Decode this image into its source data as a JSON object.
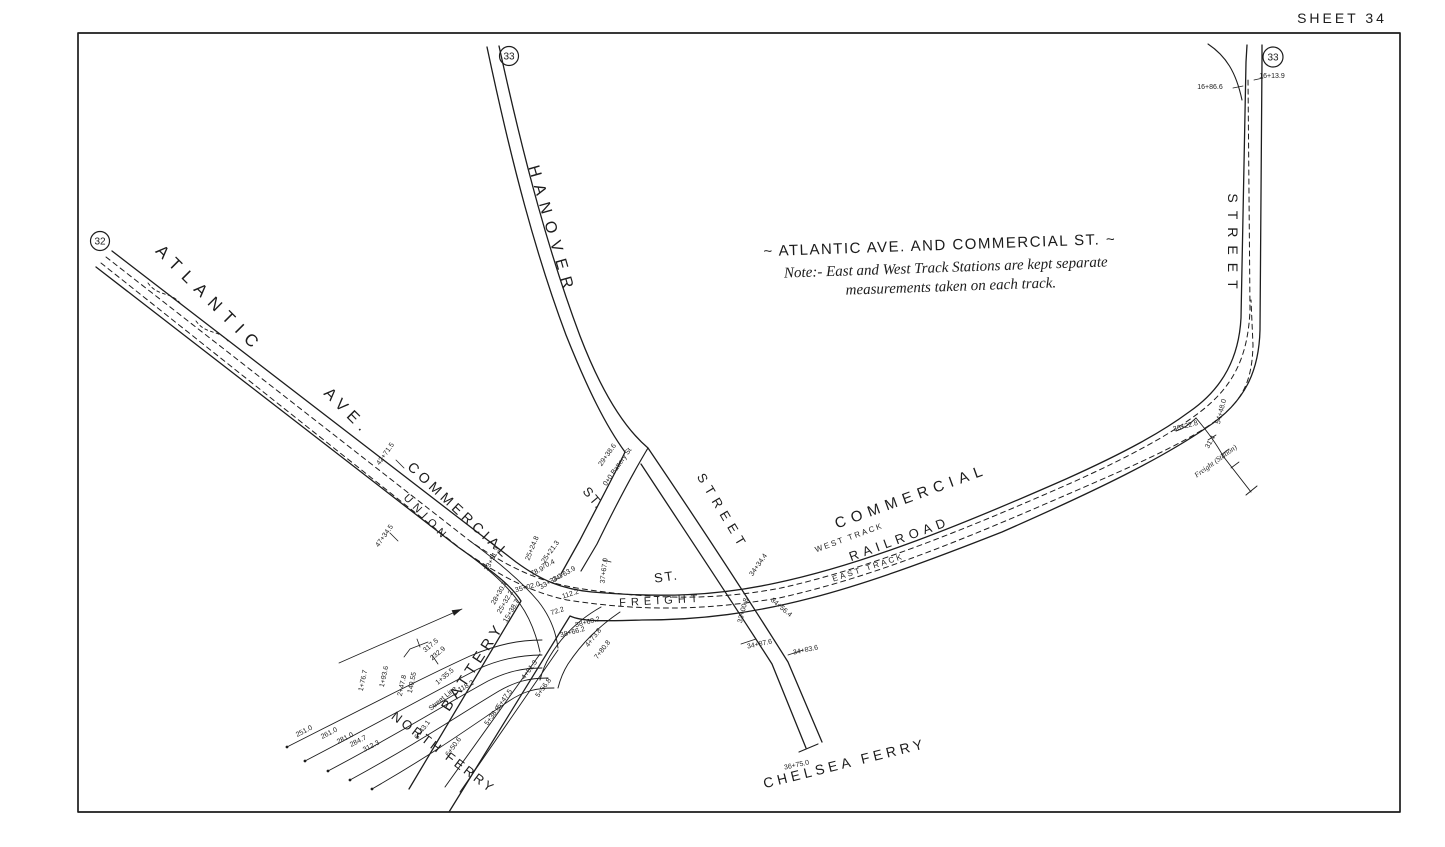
{
  "sheet_label": "SHEET 34",
  "reference_circles": {
    "west": "32",
    "hanover": "33",
    "northeast": "33"
  },
  "note_block": {
    "title": "~ ATLANTIC AVE. AND COMMERCIAL ST. ~",
    "line1": "Note:- East and West Track Stations are kept separate",
    "line2": "measurements taken on each track."
  },
  "street_labels": {
    "atlantic": "ATLANTIC",
    "ave": "AVE.",
    "commercial_west": "COMMERCIAL",
    "union": "UNION",
    "hanover": "HANOVER",
    "hanover_st": "ST.",
    "chelsea_street": "STREET",
    "commercial_st": "ST.",
    "freight": "FREIGHT",
    "commercial_east": "COMMERCIAL",
    "railroad": "RAILROAD",
    "west_track": "WEST TRACK",
    "east_track": "EAST TRACK",
    "street_right": "STREET",
    "battery": "BATTERY",
    "north_ferry": "NORTH FERRY",
    "chelsea_ferry": "CHELSEA FERRY",
    "freight_station": "Freight (Station)"
  },
  "stations": [
    "16+86.6",
    "16+13.9",
    "29+38.6",
    "0+0 Battery St",
    "42+71.5",
    "47+34.5",
    "37+67.0",
    "34+34.4",
    "33+00.8",
    "34+56.4",
    "34+87.6",
    "34+83.6",
    "36+75.0",
    "25+24.8",
    "25+21.3",
    "70.4",
    "33+51.3",
    "78.9",
    "34+63.9",
    "33+33.1",
    "35+02.0",
    "112.2",
    "72.2",
    "28+30.7",
    "25+32.2",
    "15+38.7",
    "38+60.2",
    "38+66.2",
    "4+73.8",
    "7+80.8",
    "4+01.3",
    "5+56.8",
    "5+47.5",
    "5+38.6",
    "6+43.1",
    "6+50.6",
    "251.0",
    "261.0",
    "281.0",
    "284.7",
    "312.3",
    "1+76.7",
    "1+93.6",
    "2+47.8",
    "140.55",
    "Street Line",
    "1+35.5",
    "118.2",
    "317.5",
    "232.9",
    "54+48.0",
    "31.4",
    "36+22.8"
  ]
}
